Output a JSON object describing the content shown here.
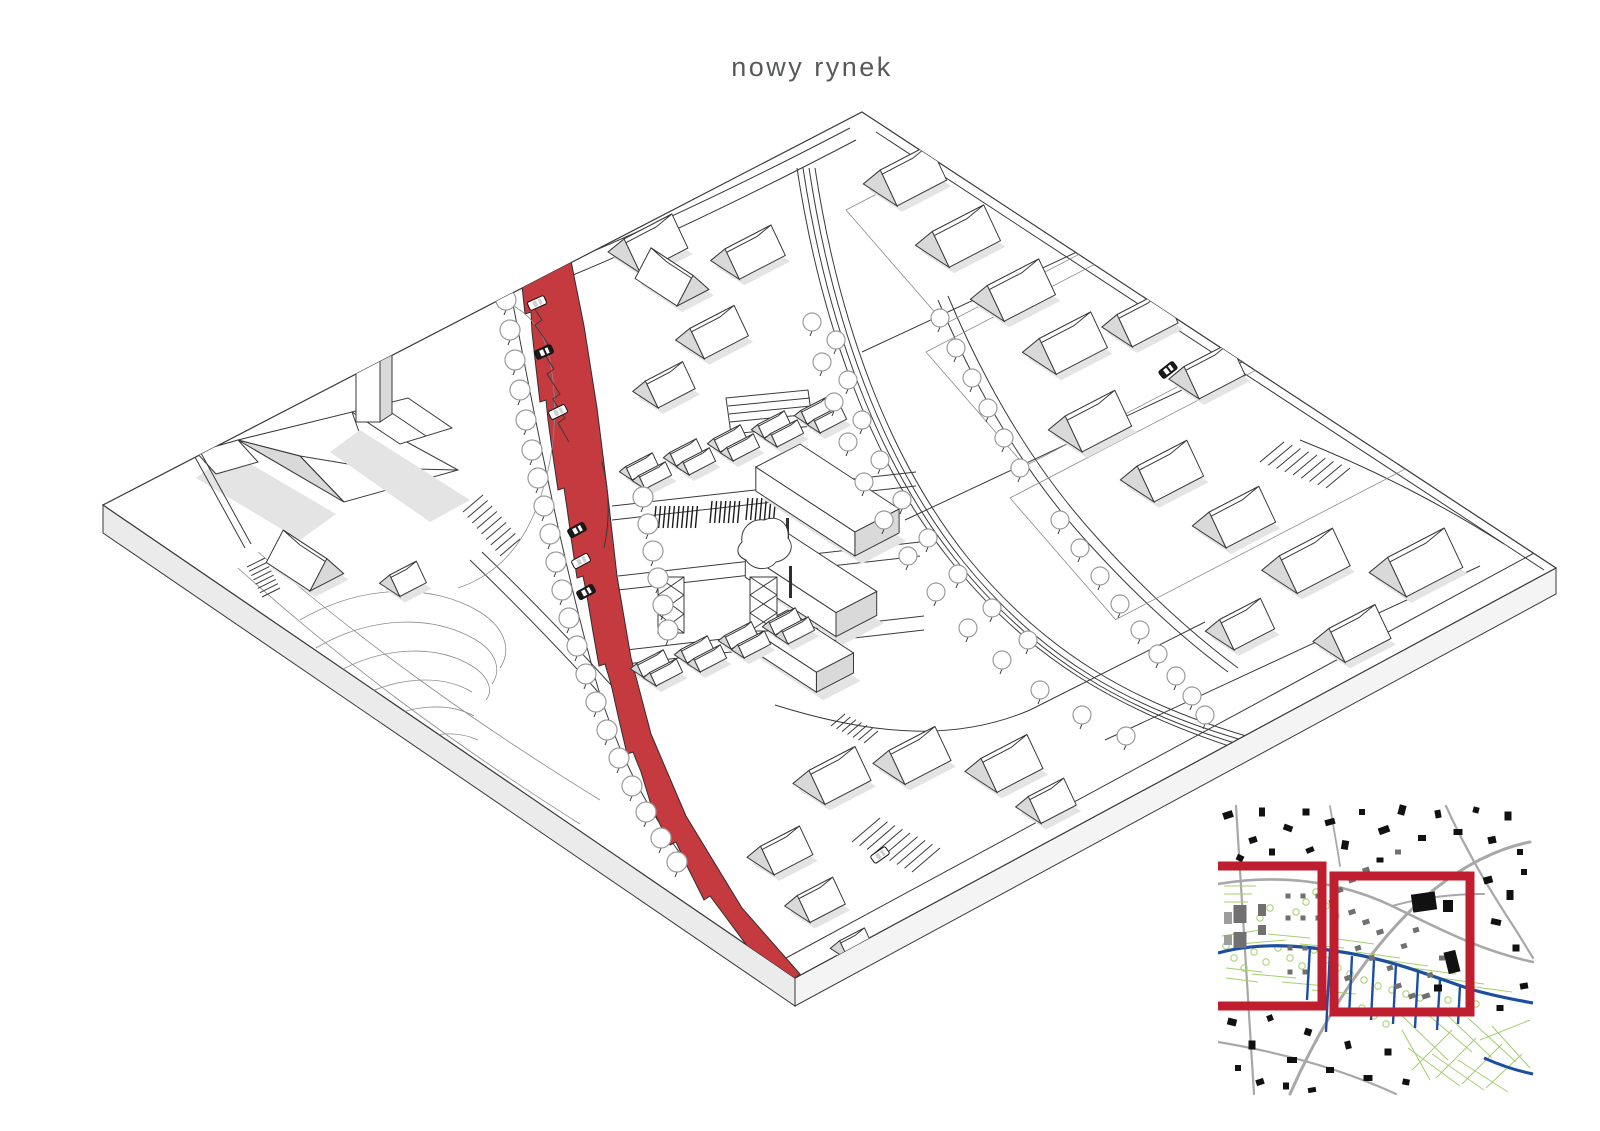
{
  "title": "nowy rynek",
  "colors": {
    "accent": "#c43a3e",
    "frame_red": "#be1e2d",
    "line": "#3a3a3a",
    "faint": "#8c8c8c",
    "shade": "#d9d9d9",
    "shadow": "#e4e4e4",
    "plate_side": "#ebebeb",
    "title_text": "#58595b",
    "map_blue": "#1d4f9e",
    "map_green": "#a5cf6b",
    "map_road": "#a8a8a8",
    "map_gray": "#707070",
    "map_black": "#111111"
  },
  "axon": {
    "houses": [
      [
        905,
        182,
        56,
        40,
        1
      ],
      [
        958,
        243,
        58,
        40,
        1
      ],
      [
        1013,
        297,
        58,
        40,
        1
      ],
      [
        1065,
        350,
        58,
        40,
        1
      ],
      [
        1140,
        325,
        52,
        36,
        1
      ],
      [
        1207,
        377,
        52,
        36,
        1
      ],
      [
        1090,
        428,
        56,
        40,
        1
      ],
      [
        1162,
        478,
        56,
        40,
        1
      ],
      [
        1234,
        524,
        56,
        40,
        1
      ],
      [
        1306,
        568,
        60,
        42,
        1
      ],
      [
        1416,
        570,
        64,
        44,
        1
      ],
      [
        1352,
        640,
        52,
        38,
        1
      ],
      [
        1240,
        630,
        46,
        34,
        1
      ],
      [
        832,
        782,
        52,
        38,
        1
      ],
      [
        912,
        762,
        52,
        38,
        1
      ],
      [
        1004,
        770,
        52,
        38,
        1
      ],
      [
        1046,
        806,
        40,
        30,
        1
      ],
      [
        780,
        856,
        44,
        32,
        1
      ],
      [
        815,
        905,
        40,
        30,
        1
      ],
      [
        852,
        948,
        28,
        22,
        1
      ],
      [
        748,
        258,
        52,
        34,
        1
      ],
      [
        712,
        338,
        50,
        34,
        1
      ],
      [
        664,
        390,
        42,
        30,
        1
      ],
      [
        648,
        250,
        54,
        38,
        1
      ],
      [
        672,
        284,
        50,
        36,
        0
      ],
      [
        305,
        568,
        52,
        38,
        0
      ],
      [
        403,
        583,
        30,
        24,
        1
      ]
    ],
    "mhouses": [
      [
        645,
        473
      ],
      [
        689,
        459
      ],
      [
        733,
        445
      ],
      [
        777,
        431
      ],
      [
        820,
        417
      ],
      [
        656,
        670
      ],
      [
        700,
        656
      ],
      [
        744,
        642
      ],
      [
        788,
        628
      ]
    ],
    "blocks": [
      [
        800,
        468,
        118,
        50,
        24
      ],
      [
        786,
        556,
        108,
        46,
        24
      ],
      [
        788,
        630,
        78,
        42,
        20
      ]
    ],
    "plinths": [
      [
        846,
        210,
        150,
        240
      ],
      [
        926,
        352,
        150,
        300
      ],
      [
        1010,
        498,
        160,
        330
      ]
    ],
    "trees_path": [
      [
        506,
        300
      ],
      [
        510,
        330
      ],
      [
        515,
        360
      ],
      [
        520,
        390
      ],
      [
        526,
        420
      ],
      [
        532,
        450
      ],
      [
        538,
        478
      ],
      [
        544,
        506
      ],
      [
        550,
        534
      ],
      [
        556,
        562
      ],
      [
        562,
        590
      ],
      [
        569,
        618
      ],
      [
        577,
        646
      ],
      [
        586,
        674
      ],
      [
        596,
        702
      ],
      [
        607,
        730
      ],
      [
        619,
        758
      ],
      [
        632,
        786
      ],
      [
        646,
        812
      ],
      [
        661,
        838
      ],
      [
        677,
        862
      ],
      [
        643,
        497
      ],
      [
        648,
        524
      ],
      [
        653,
        551
      ],
      [
        658,
        578
      ],
      [
        663,
        605
      ],
      [
        668,
        630
      ]
    ],
    "trees_ave": [
      [
        812,
        322
      ],
      [
        822,
        362
      ],
      [
        834,
        402
      ],
      [
        848,
        442
      ],
      [
        864,
        482
      ],
      [
        884,
        520
      ],
      [
        908,
        556
      ],
      [
        936,
        592
      ],
      [
        968,
        628
      ],
      [
        1002,
        660
      ],
      [
        1040,
        690
      ],
      [
        1082,
        715
      ],
      [
        1126,
        736
      ],
      [
        836,
        340
      ],
      [
        848,
        380
      ],
      [
        862,
        420
      ],
      [
        880,
        460
      ],
      [
        902,
        500
      ],
      [
        928,
        538
      ],
      [
        958,
        574
      ],
      [
        992,
        608
      ],
      [
        1028,
        640
      ]
    ],
    "trees_s2": [
      [
        940,
        318
      ],
      [
        956,
        348
      ],
      [
        972,
        378
      ],
      [
        988,
        408
      ],
      [
        1004,
        438
      ],
      [
        1020,
        468
      ],
      [
        1060,
        520
      ],
      [
        1080,
        548
      ],
      [
        1100,
        576
      ],
      [
        1120,
        604
      ],
      [
        1140,
        630
      ],
      [
        1158,
        654
      ],
      [
        1176,
        676
      ],
      [
        1192,
        696
      ],
      [
        1205,
        715
      ]
    ],
    "cars": [
      [
        537,
        303,
        -24,
        0
      ],
      [
        544,
        352,
        -24,
        1
      ],
      [
        558,
        412,
        -26,
        0
      ],
      [
        577,
        530,
        -28,
        1
      ],
      [
        581,
        561,
        -28,
        0
      ],
      [
        586,
        592,
        -28,
        1
      ],
      [
        1168,
        370,
        -38,
        1
      ],
      [
        880,
        855,
        -35,
        0
      ]
    ],
    "stalls": [
      {
        "x": 656,
        "y": 506,
        "n": 10
      },
      {
        "x": 712,
        "y": 501,
        "n": 7
      },
      {
        "x": 748,
        "y": 498,
        "n": 7
      }
    ],
    "stairs": [
      {
        "a": [
          463,
          512
        ],
        "b": [
          500,
          556
        ],
        "r": [
          20,
          -17
        ],
        "n": 8
      },
      {
        "a": [
          247,
          567
        ],
        "b": [
          262,
          597
        ],
        "r": [
          18,
          -9
        ],
        "n": 7
      },
      {
        "a": [
          845,
          714
        ],
        "b": [
          878,
          731
        ],
        "r": [
          -14,
          12
        ],
        "n": 6
      },
      {
        "a": [
          852,
          842
        ],
        "b": [
          912,
          872
        ],
        "r": [
          28,
          -24
        ],
        "n": 8
      },
      {
        "a": [
          1260,
          462
        ],
        "b": [
          1326,
          488
        ],
        "r": [
          24,
          -20
        ],
        "n": 8
      }
    ],
    "kiosks": [
      [
        786,
        518
      ],
      [
        789,
        566
      ],
      [
        792,
        616
      ]
    ]
  },
  "map": {
    "buildings": [
      [
        1228,
        815,
        10,
        7,
        -18,
        0
      ],
      [
        1253,
        840,
        8,
        6,
        -18,
        0
      ],
      [
        1262,
        812,
        6,
        9,
        0,
        0
      ],
      [
        1288,
        828,
        9,
        6,
        20,
        0
      ],
      [
        1306,
        812,
        7,
        7,
        0,
        0
      ],
      [
        1330,
        822,
        10,
        6,
        -15,
        0
      ],
      [
        1345,
        845,
        7,
        9,
        10,
        0
      ],
      [
        1362,
        812,
        6,
        6,
        0,
        0
      ],
      [
        1384,
        830,
        11,
        7,
        -20,
        0
      ],
      [
        1402,
        810,
        7,
        10,
        15,
        0
      ],
      [
        1422,
        838,
        8,
        6,
        0,
        0
      ],
      [
        1438,
        814,
        6,
        8,
        -10,
        0
      ],
      [
        1458,
        832,
        9,
        6,
        0,
        0
      ],
      [
        1476,
        810,
        6,
        6,
        15,
        0
      ],
      [
        1492,
        840,
        8,
        7,
        -12,
        0
      ],
      [
        1508,
        816,
        7,
        9,
        0,
        0
      ],
      [
        1520,
        852,
        6,
        6,
        0,
        0
      ],
      [
        1240,
        858,
        7,
        6,
        25,
        0
      ],
      [
        1272,
        852,
        6,
        7,
        0,
        0
      ],
      [
        1310,
        850,
        8,
        5,
        -22,
        0
      ],
      [
        1488,
        880,
        9,
        7,
        -15,
        0
      ],
      [
        1510,
        895,
        7,
        10,
        0,
        0
      ],
      [
        1524,
        872,
        6,
        6,
        0,
        0
      ],
      [
        1496,
        922,
        10,
        6,
        12,
        0
      ],
      [
        1516,
        948,
        7,
        7,
        0,
        0
      ],
      [
        1524,
        986,
        8,
        6,
        -10,
        0
      ],
      [
        1500,
        1008,
        7,
        6,
        0,
        0
      ],
      [
        1232,
        1022,
        9,
        7,
        14,
        0
      ],
      [
        1252,
        1045,
        7,
        9,
        0,
        0
      ],
      [
        1270,
        1018,
        6,
        6,
        -20,
        0
      ],
      [
        1292,
        1060,
        10,
        6,
        0,
        0
      ],
      [
        1308,
        1032,
        7,
        7,
        18,
        0
      ],
      [
        1330,
        1070,
        8,
        6,
        0,
        0
      ],
      [
        1348,
        1045,
        6,
        8,
        -14,
        0
      ],
      [
        1368,
        1078,
        9,
        6,
        0,
        0
      ],
      [
        1388,
        1052,
        7,
        7,
        0,
        0
      ],
      [
        1260,
        1082,
        8,
        6,
        -18,
        0
      ],
      [
        1238,
        1068,
        6,
        6,
        0,
        0
      ],
      [
        1406,
        1082,
        7,
        6,
        12,
        0
      ],
      [
        1286,
        1086,
        6,
        7,
        0,
        0
      ],
      [
        1312,
        1090,
        8,
        5,
        -10,
        0
      ],
      [
        1352,
        912,
        7,
        5,
        -18,
        1
      ],
      [
        1366,
        922,
        7,
        5,
        -18,
        1
      ],
      [
        1380,
        932,
        7,
        5,
        -18,
        1
      ],
      [
        1358,
        948,
        6,
        5,
        -18,
        1
      ],
      [
        1372,
        958,
        6,
        5,
        -18,
        1
      ],
      [
        1390,
        968,
        6,
        5,
        -18,
        1
      ],
      [
        1348,
        978,
        7,
        5,
        -18,
        1
      ],
      [
        1404,
        946,
        6,
        5,
        -18,
        1
      ],
      [
        1416,
        930,
        6,
        5,
        -18,
        1
      ],
      [
        1398,
        986,
        7,
        5,
        -18,
        1
      ],
      [
        1412,
        996,
        7,
        5,
        -18,
        1
      ],
      [
        1430,
        975,
        6,
        5,
        -18,
        1
      ],
      [
        1426,
        996,
        8,
        5,
        -18,
        1
      ],
      [
        1442,
        958,
        6,
        5,
        0,
        1
      ],
      [
        1424,
        902,
        24,
        18,
        -8,
        0
      ],
      [
        1448,
        906,
        10,
        12,
        0,
        0
      ],
      [
        1452,
        962,
        12,
        22,
        -14,
        0
      ],
      [
        1438,
        988,
        8,
        7,
        0,
        0
      ],
      [
        1240,
        914,
        13,
        18,
        0,
        1
      ],
      [
        1240,
        940,
        13,
        16,
        0,
        1
      ],
      [
        1228,
        918,
        8,
        12,
        0,
        2
      ],
      [
        1228,
        940,
        8,
        10,
        0,
        2
      ],
      [
        1262,
        910,
        8,
        12,
        0,
        1
      ],
      [
        1262,
        930,
        8,
        10,
        0,
        1
      ],
      [
        1288,
        896,
        5,
        5,
        0,
        1
      ],
      [
        1303,
        896,
        5,
        5,
        0,
        1
      ],
      [
        1318,
        896,
        5,
        5,
        0,
        1
      ],
      [
        1288,
        918,
        5,
        5,
        0,
        1
      ],
      [
        1303,
        918,
        5,
        5,
        0,
        1
      ],
      [
        1318,
        918,
        5,
        5,
        0,
        1
      ],
      [
        1290,
        948,
        5,
        5,
        0,
        1
      ],
      [
        1305,
        948,
        5,
        5,
        0,
        1
      ],
      [
        1290,
        972,
        5,
        5,
        0,
        1
      ],
      [
        1305,
        972,
        5,
        5,
        0,
        1
      ],
      [
        1332,
        902,
        6,
        5,
        -18,
        1
      ],
      [
        1340,
        890,
        6,
        5,
        -18,
        1
      ],
      [
        1352,
        880,
        7,
        5,
        -18,
        1
      ],
      [
        1366,
        870,
        7,
        5,
        -18,
        1
      ],
      [
        1380,
        860,
        7,
        5,
        0,
        0
      ],
      [
        1398,
        852,
        6,
        5,
        0,
        1
      ]
    ],
    "trees": [
      [
        1226,
        946
      ],
      [
        1234,
        958
      ],
      [
        1244,
        968
      ],
      [
        1254,
        952
      ],
      [
        1266,
        962
      ],
      [
        1278,
        948
      ],
      [
        1290,
        958
      ],
      [
        1302,
        966
      ],
      [
        1314,
        950
      ],
      [
        1326,
        960
      ],
      [
        1338,
        968
      ],
      [
        1350,
        974
      ],
      [
        1364,
        980
      ],
      [
        1378,
        986
      ],
      [
        1392,
        990
      ],
      [
        1406,
        994
      ],
      [
        1420,
        998
      ],
      [
        1448,
        1000
      ],
      [
        1476,
        1004
      ],
      [
        1296,
        912
      ],
      [
        1306,
        902
      ],
      [
        1316,
        892
      ],
      [
        1326,
        906
      ],
      [
        1336,
        916
      ],
      [
        1260,
        918
      ],
      [
        1270,
        908
      ],
      [
        1362,
        1008
      ],
      [
        1374,
        1016
      ],
      [
        1386,
        1024
      ]
    ],
    "green": [
      [
        1222,
        936,
        1260,
        930
      ],
      [
        1240,
        944,
        1286,
        940
      ],
      [
        1268,
        934,
        1310,
        938
      ],
      [
        1300,
        944,
        1344,
        948
      ],
      [
        1330,
        938,
        1374,
        944
      ],
      [
        1356,
        952,
        1400,
        958
      ],
      [
        1384,
        960,
        1428,
        966
      ],
      [
        1412,
        968,
        1456,
        974
      ],
      [
        1440,
        978,
        1484,
        984
      ],
      [
        1468,
        986,
        1512,
        992
      ],
      [
        1252,
        974,
        1296,
        978
      ],
      [
        1282,
        982,
        1326,
        986
      ],
      [
        1312,
        990,
        1356,
        994
      ],
      [
        1400,
        1014,
        1448,
        1060
      ],
      [
        1420,
        1008,
        1472,
        1052
      ],
      [
        1444,
        1012,
        1492,
        1058
      ],
      [
        1468,
        1018,
        1516,
        1062
      ],
      [
        1492,
        1026,
        1530,
        1068
      ],
      [
        1408,
        1048,
        1460,
        1086
      ],
      [
        1432,
        1054,
        1484,
        1090
      ],
      [
        1458,
        1060,
        1508,
        1092
      ],
      [
        1402,
        1030,
        1430,
        1080
      ],
      [
        1480,
        1040,
        1530,
        1020
      ],
      [
        1412,
        1070,
        1452,
        1030
      ],
      [
        1436,
        1078,
        1476,
        1038
      ],
      [
        1462,
        1084,
        1502,
        1044
      ],
      [
        1486,
        1088,
        1522,
        1054
      ],
      [
        1224,
        886,
        1256,
        886
      ],
      [
        1224,
        894,
        1252,
        894
      ],
      [
        1224,
        902,
        1248,
        902
      ],
      [
        1226,
        968,
        1262,
        972
      ],
      [
        1226,
        978,
        1258,
        982
      ]
    ],
    "spurs": [
      [
        1330,
        950,
        1326,
        1032
      ],
      [
        1352,
        956,
        1349,
        1016
      ],
      [
        1374,
        960,
        1371,
        1020
      ],
      [
        1396,
        964,
        1393,
        1024
      ],
      [
        1418,
        972,
        1415,
        1028
      ],
      [
        1440,
        980,
        1437,
        1030
      ],
      [
        1460,
        986,
        1458,
        1024
      ],
      [
        1310,
        946,
        1307,
        1000
      ]
    ]
  }
}
